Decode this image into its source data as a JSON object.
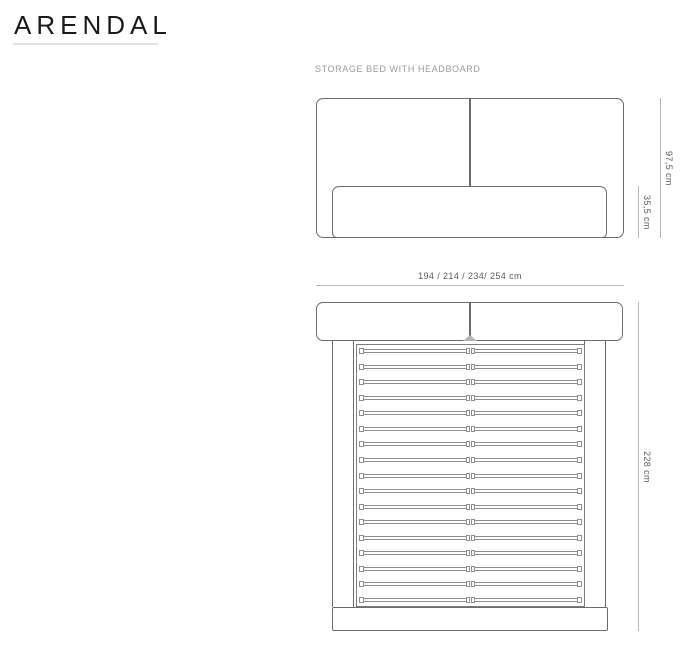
{
  "title": "ARENDAL",
  "caption": "STORAGE BED WITH HEADBOARD",
  "front_view": {
    "total_height_label": "97,5 cm",
    "base_height_label": "35,5 cm"
  },
  "top_view": {
    "width_label": "194 / 214 / 234/ 254 cm",
    "depth_label": "228 cm",
    "slat_count": 17
  },
  "colors": {
    "outline": "#6b6b6b",
    "slat_line": "#8f8f8f",
    "dimension_line": "#b8b8b8",
    "dimension_text": "#5a5a5a",
    "caption_text": "#9a9a9a",
    "title_text": "#1a1a1a"
  }
}
